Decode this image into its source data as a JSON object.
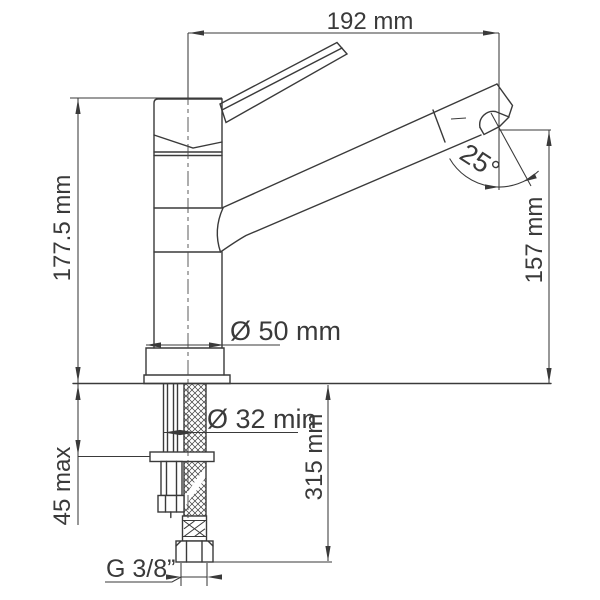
{
  "diagram": {
    "type": "technical-drawing",
    "subject": "kitchen faucet installation dimension drawing",
    "colors": {
      "line": "#3a3a3a",
      "background": "#ffffff"
    },
    "labels": {
      "spout_reach_width": "192 mm",
      "overall_height": "177.5 mm",
      "spout_angle": "25°",
      "spout_outlet_height": "157 mm",
      "base_diameter": "Ø 50 mm",
      "mounting_hole_min_diameter": "Ø 32 min",
      "hose_length_below_deck": "315 mm",
      "max_deck_thickness": "45 max",
      "supply_thread": "G 3/8”"
    }
  }
}
